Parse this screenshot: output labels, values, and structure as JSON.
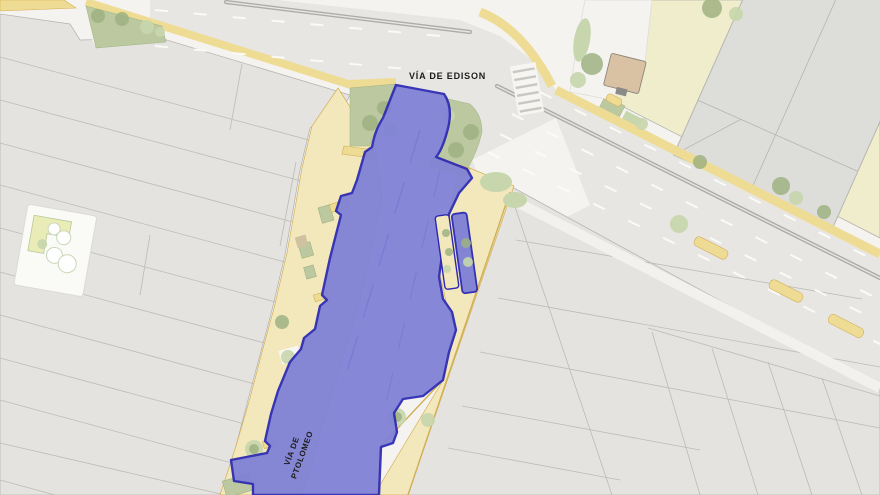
{
  "map": {
    "labels": {
      "edison": "VÍA DE EDISON",
      "ptolomeo_line1": "VÍA DE",
      "ptolomeo_line2": "PTOLOMEO"
    },
    "colors": {
      "selection_fill": "#7E80D6",
      "selection_border": "#2B28B4",
      "road": "#E7E6E3",
      "road_marking": "#FBFBF8",
      "median": "#ADACA8",
      "parcel": "#E4E3E0",
      "parcel_line": "#BDBBB5",
      "block_cream": "#EFEDCB",
      "sidewalk_cream": "#F2E8BC",
      "sidewalk_yellow": "#EFDC94",
      "curb": "#D2AF56",
      "green": "#BCC9A0",
      "tree_dark": "#9FB181",
      "tree_light": "#C7D6AC",
      "white_zone": "#F4F3F0",
      "building_tan": "#D9C2A4",
      "building_gray": "#DDDDDA",
      "outline": "#B7B5B0",
      "label": "#1C1C1C"
    }
  }
}
